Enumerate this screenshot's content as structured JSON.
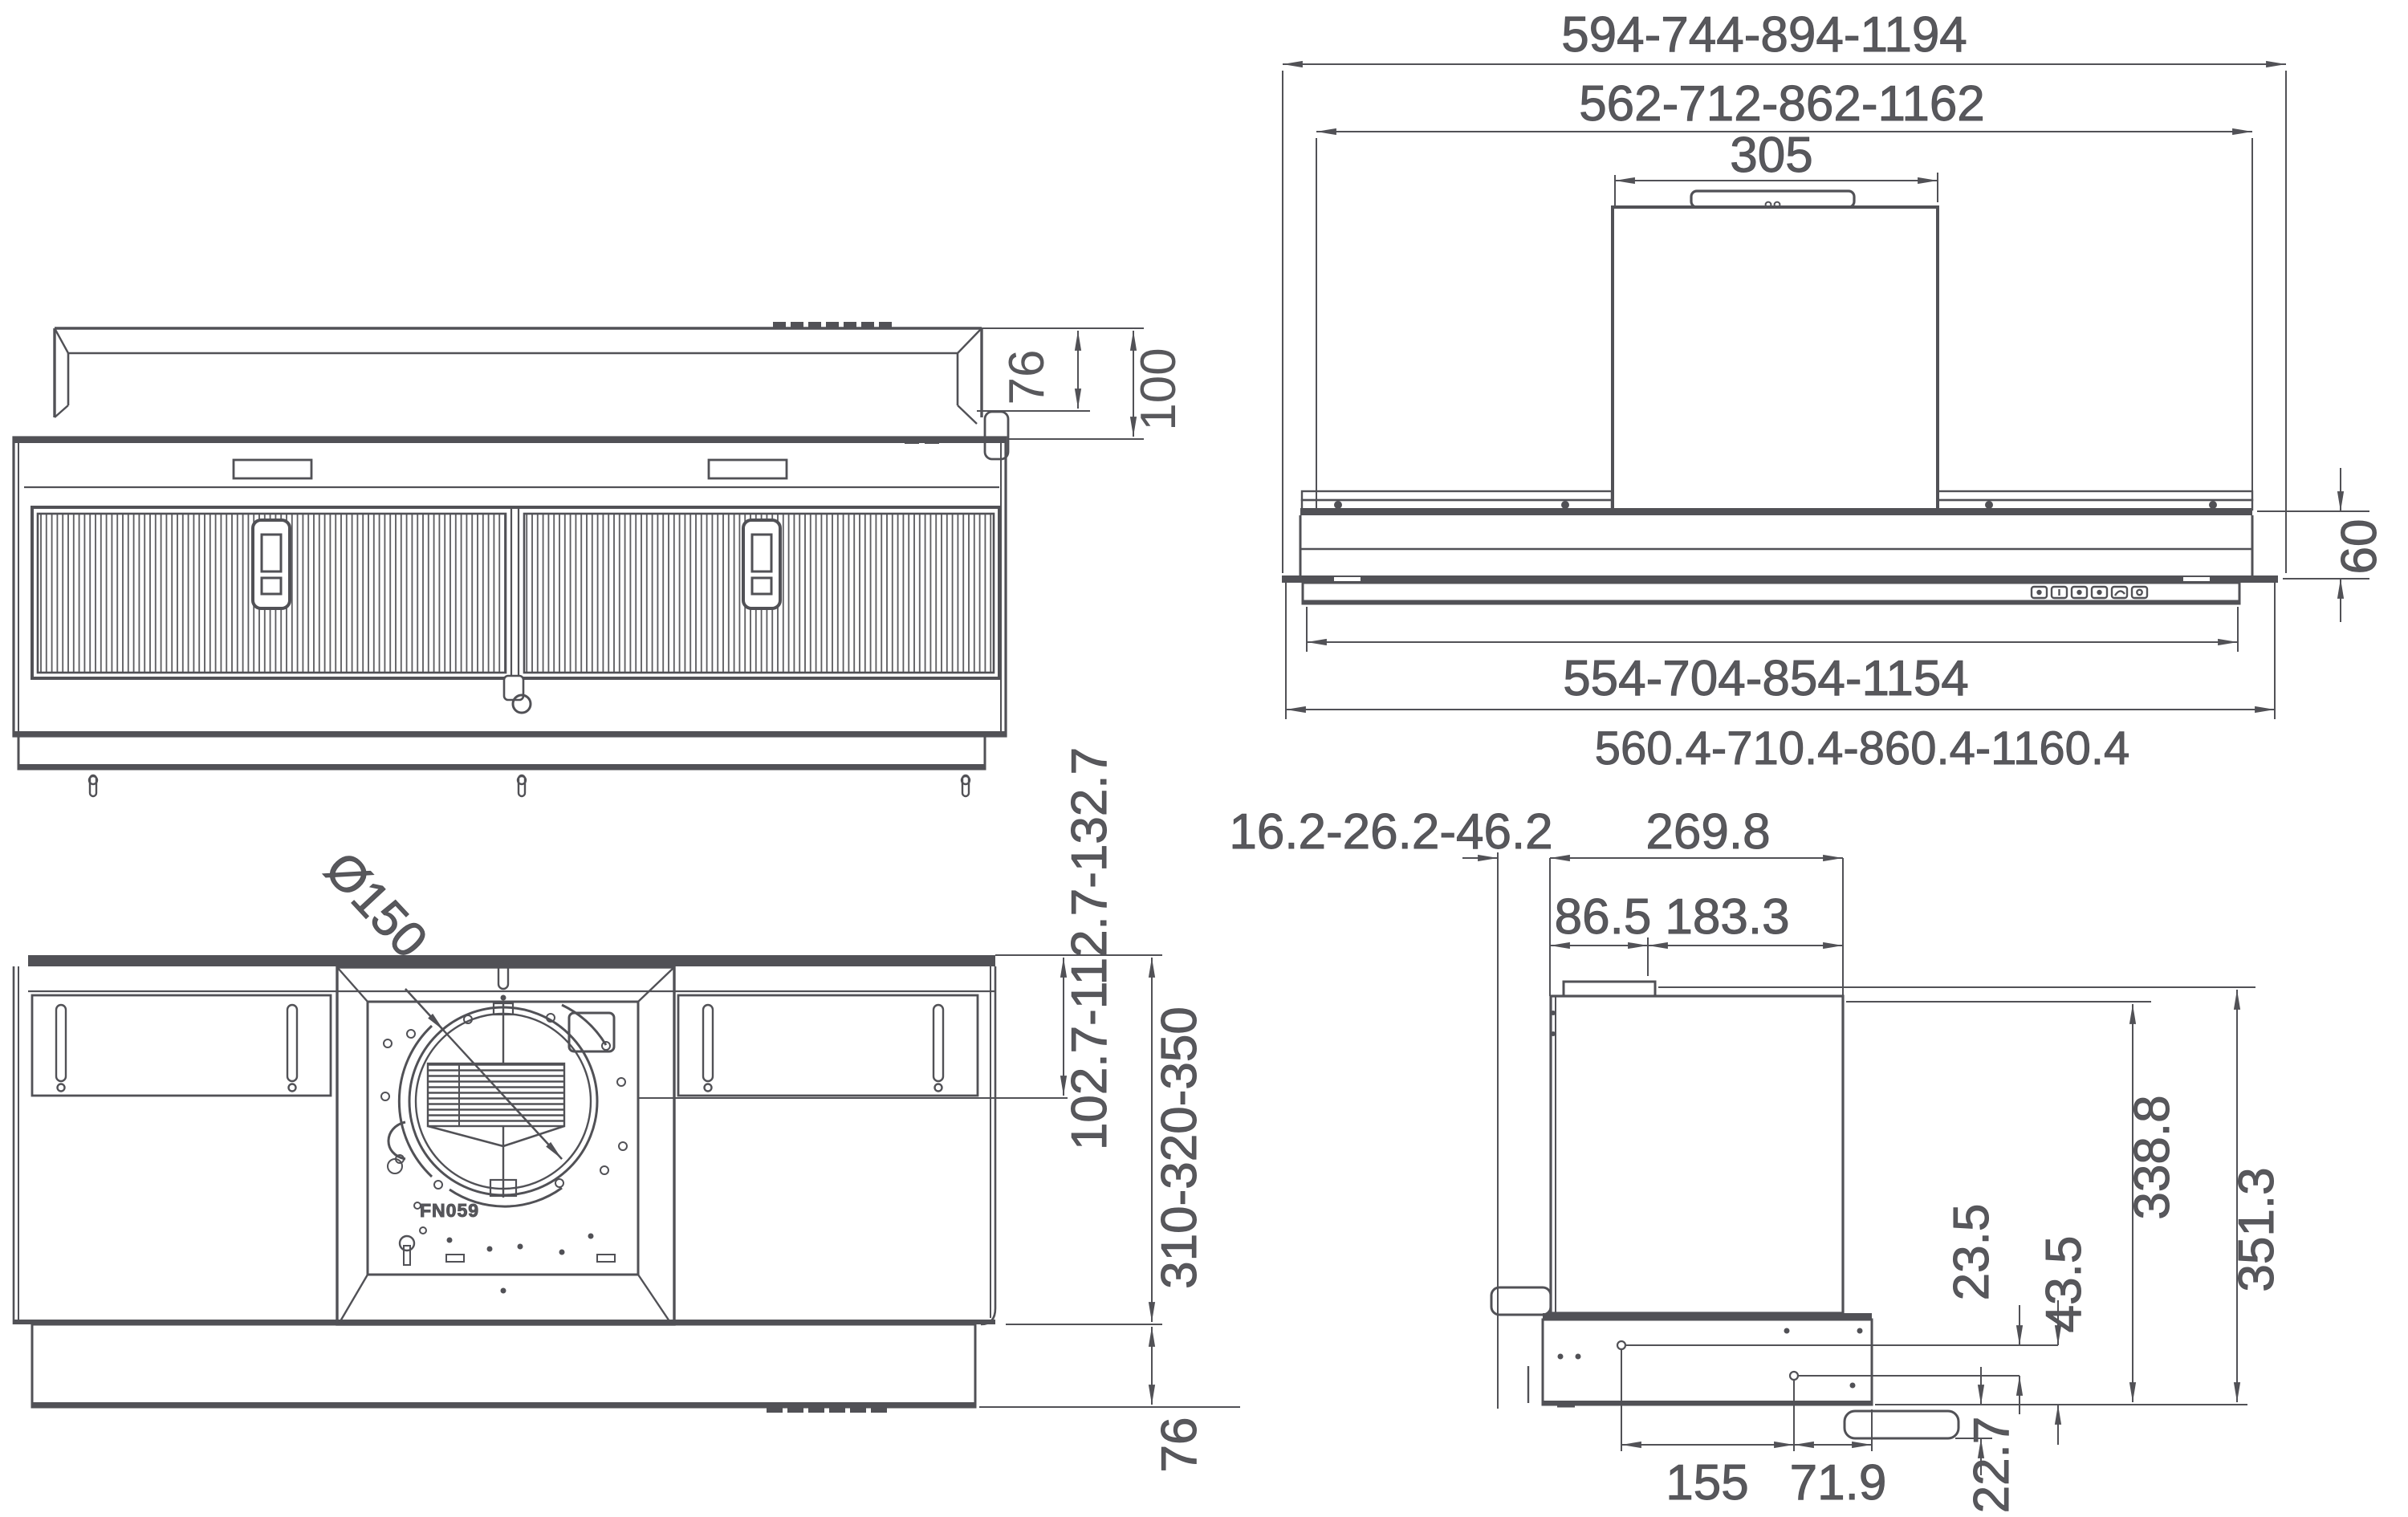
{
  "title": "Range hood dimensional drawing (4 views)",
  "units": "mm",
  "colors": {
    "line": "#515156",
    "text": "#58585c",
    "background": "#ffffff"
  },
  "bottom_view": {
    "upper_depth": "76",
    "total_depth": "100"
  },
  "front_view": {
    "overall_width": "594-744-894-1194",
    "body_width": "562-712-862-1162",
    "chimney_width": "305",
    "body_height": "60",
    "filter_width": "554-704-854-1154",
    "recess_width": "560.4-710.4-860.4-1160.4"
  },
  "top_view": {
    "duct_diameter": "Ø150",
    "motor_label": "FN059",
    "duct_center_offset": "102.7-112.7-132.7",
    "body_depth": "310-320-350",
    "plinth_depth": "76"
  },
  "side_view": {
    "wall_clearance": "16.2-26.2-46.2",
    "body_depth": "269.8",
    "duct_rear": "86.5",
    "duct_front": "183.3",
    "hole_offset_1": "23.5",
    "hole_offset_2": "43.5",
    "lip_height": "22.7",
    "body_height": "338.8",
    "total_height": "351.3",
    "hole_spacing": "155",
    "hole_to_front": "71.9"
  }
}
